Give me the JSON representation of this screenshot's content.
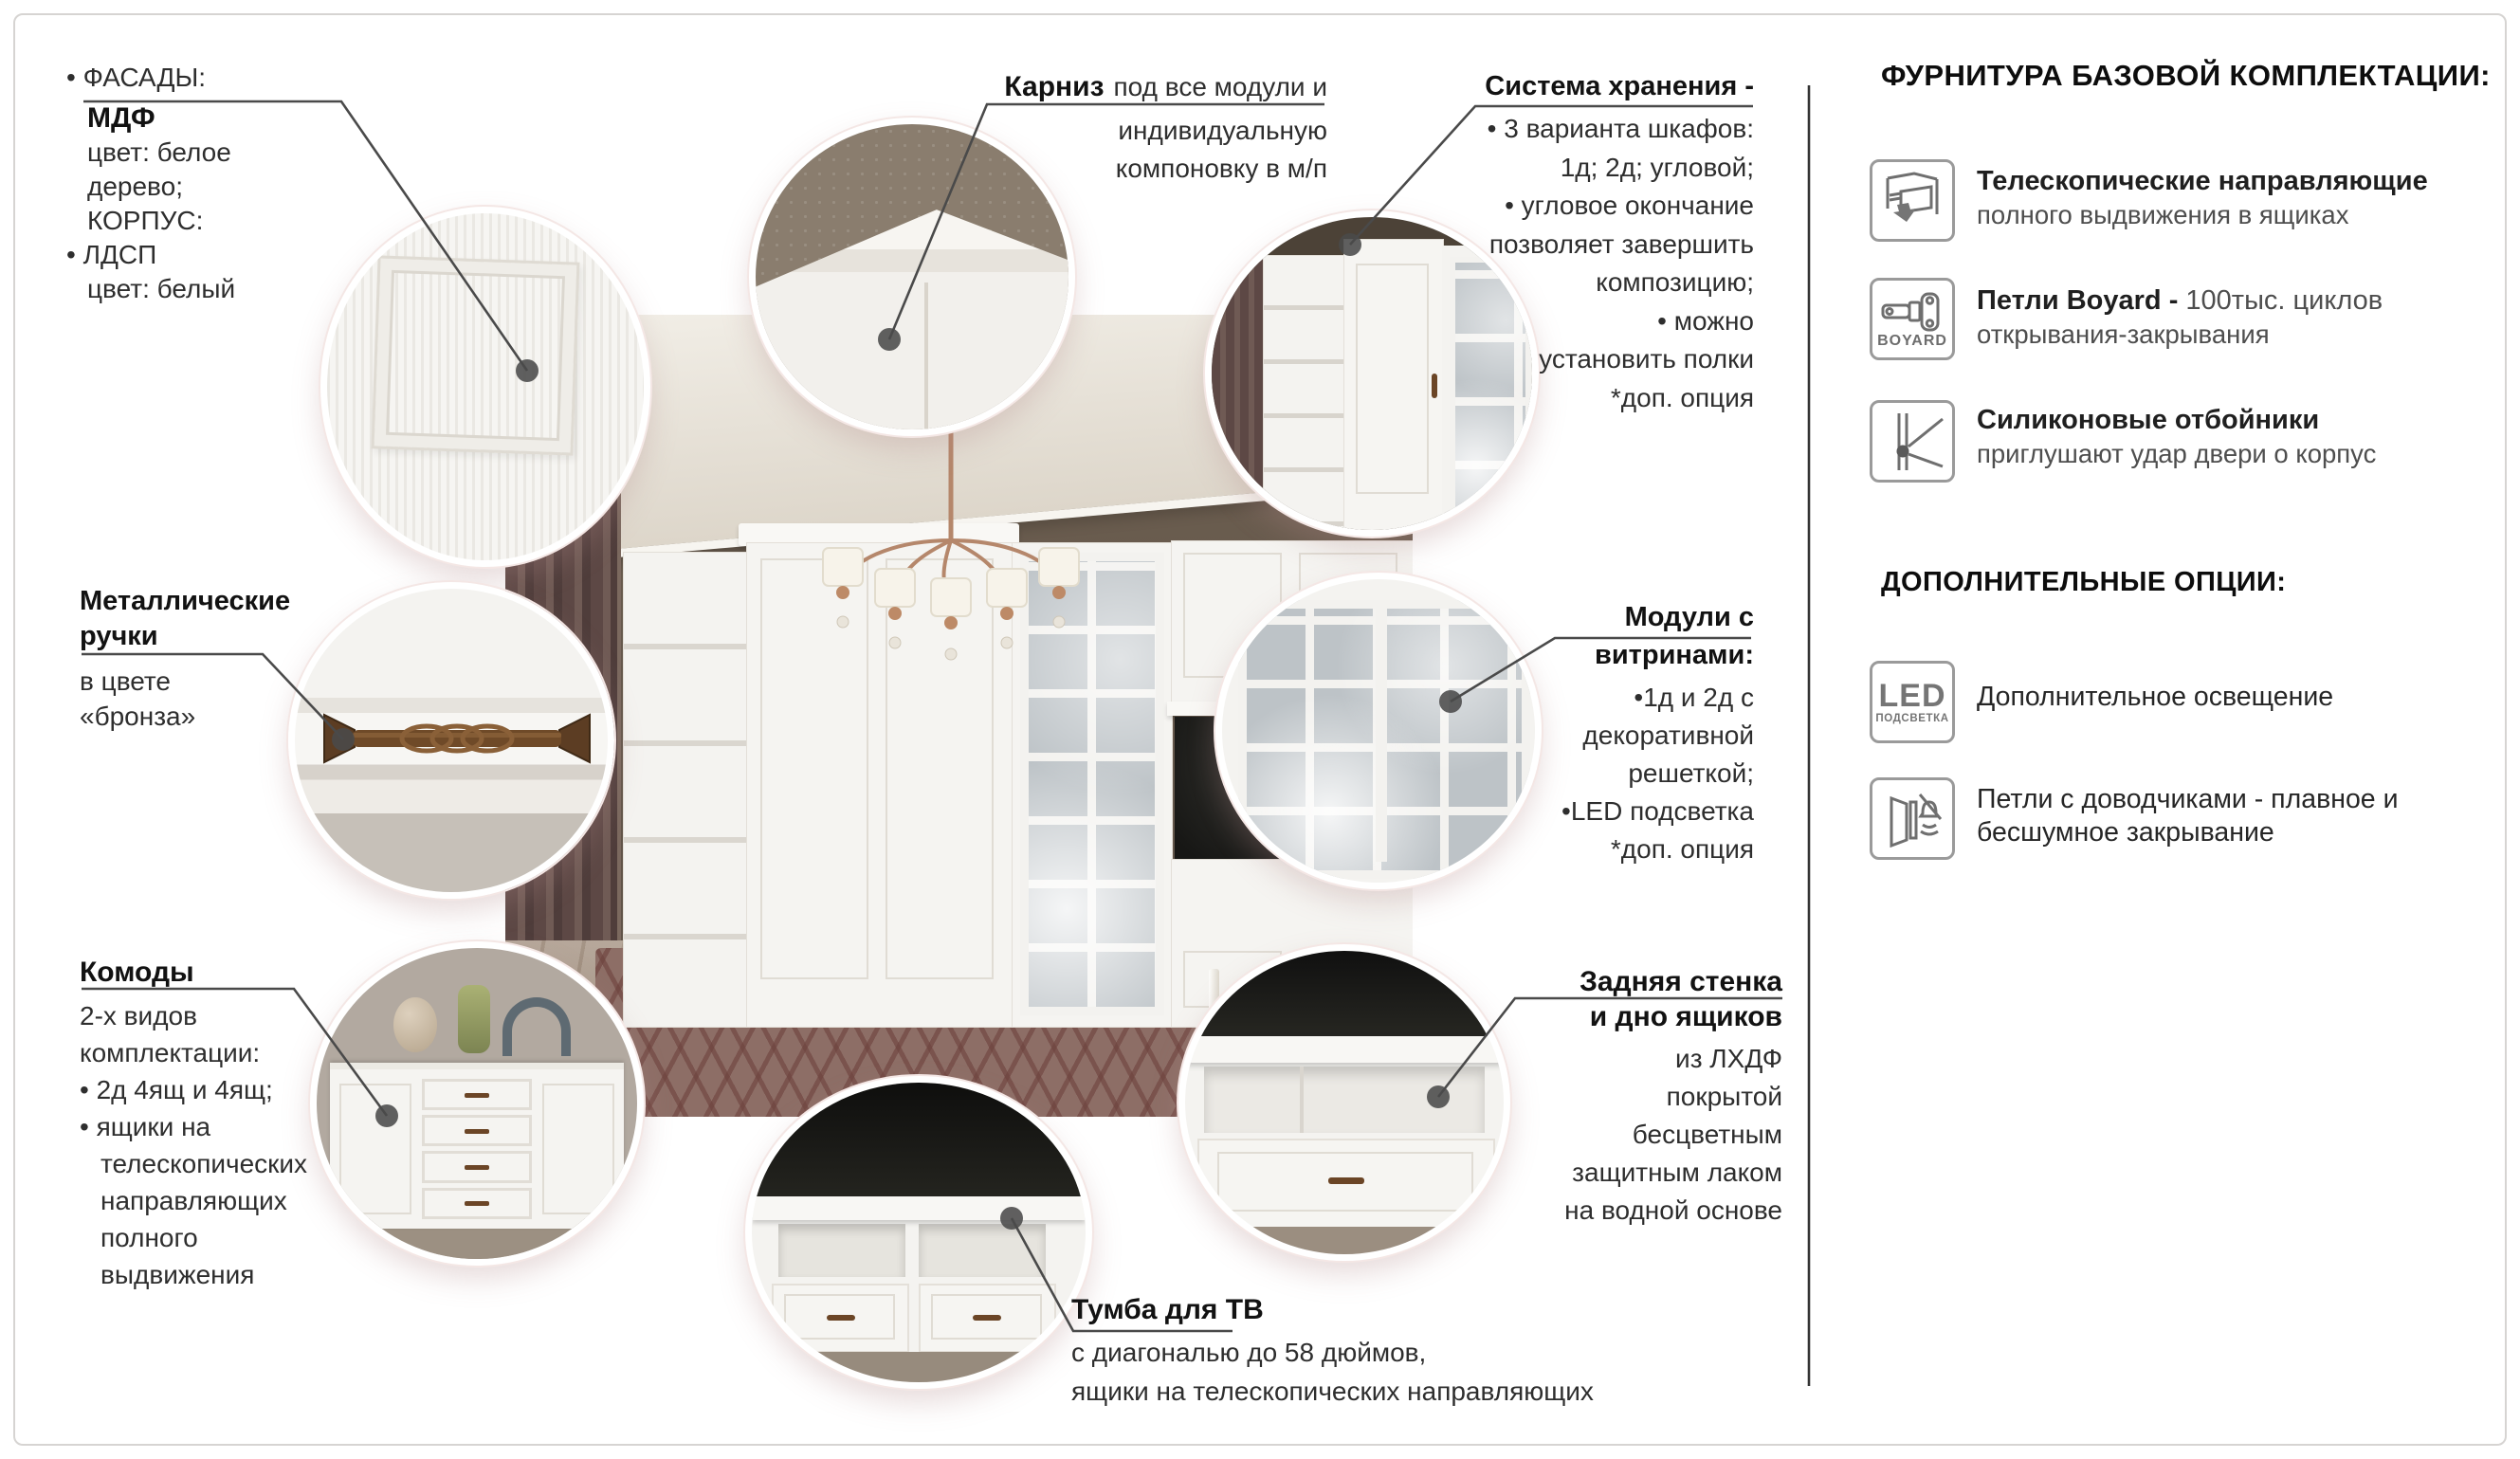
{
  "callouts": {
    "facades": {
      "line1": "• ФАСАДЫ:",
      "title": "МДФ",
      "lines": [
        "цвет: белое",
        "дерево;",
        "КОРПУС:",
        "• ЛДСП",
        "цвет: белый"
      ]
    },
    "cornice": {
      "title": "Карниз",
      "title_rest": "под все модули и",
      "lines": [
        "индивидуальную",
        "компоновку в м/п"
      ]
    },
    "storage": {
      "title": "Система хранения -",
      "lines": [
        "• 3 варианта шкафов:",
        "1д; 2д; угловой;",
        "• угловое окончание",
        "позволяет завершить",
        "композицию;",
        "• можно",
        "установить полки",
        "*доп. опция"
      ]
    },
    "handles": {
      "title1": "Металлические",
      "title2": "ручки",
      "lines": [
        "в цвете",
        "«бронза»"
      ]
    },
    "vitrines": {
      "title1": "Модули с",
      "title2": "витринами:",
      "lines": [
        "•1д и 2д с",
        "декоративной",
        "решеткой;",
        "•LED подсветка",
        "*доп. опция"
      ]
    },
    "dressers": {
      "title": "Комоды",
      "lines": [
        "2-х видов",
        "комплектации:",
        "• 2д 4ящ и 4ящ;",
        "• ящики на",
        "телескопических",
        "направляющих",
        "полного",
        "выдвижения"
      ]
    },
    "tv_stand": {
      "title": "Тумба для ТВ",
      "lines": [
        "с диагональю до 58 дюймов,",
        "ящики на телескопических направляющих"
      ]
    },
    "back_panel": {
      "title1": "Задняя стенка",
      "title2": "и дно ящиков",
      "lines": [
        "из ЛХДФ",
        "покрытой",
        "бесцветным",
        "защитным лаком",
        "на водной основе"
      ]
    }
  },
  "sidebar": {
    "base_title": "ФУРНИТУРА БАЗОВОЙ КОМПЛЕКТАЦИИ:",
    "base_items": [
      {
        "icon": "drawer-slides-icon",
        "title": "Телескопические направляющие",
        "line2": "полного выдвижения в ящиках"
      },
      {
        "icon": "boyard-hinge-icon",
        "icon_label": "BOYARD",
        "title": "Петли Boyard -",
        "title_tail": "100тыс. циклов",
        "line2": "открывания-закрывания"
      },
      {
        "icon": "silicone-bumper-icon",
        "title": "Силиконовые отбойники",
        "line2": "приглушают удар двери о корпус"
      }
    ],
    "options_title": "ДОПОЛНИТЕЛЬНЫЕ ОПЦИИ:",
    "option_items": [
      {
        "icon": "led-light-icon",
        "icon_label": "LED",
        "icon_sublabel": "ПОДСВЕТКА",
        "line1": "Дополнительное освещение"
      },
      {
        "icon": "soft-close-hinge-icon",
        "line1": "Петли с доводчиками - плавное и",
        "line2": "бесшумное закрывание"
      }
    ]
  },
  "colors": {
    "leader": "#4a4a4a",
    "bronze": "#6b4526",
    "ring": "#ffffff"
  }
}
